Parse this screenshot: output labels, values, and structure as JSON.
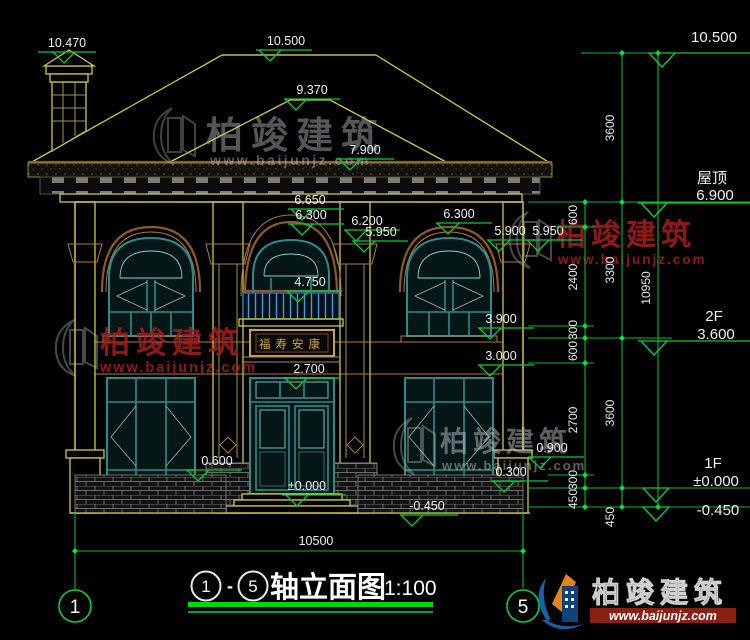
{
  "fm": [
    "10.470",
    "10.500",
    "9.370",
    "7.900",
    "6.650",
    "6.300",
    "6.200",
    "5.950",
    "6.300",
    "5.900",
    "5.950",
    "4.750",
    "3.900",
    "3.000",
    "2.700",
    "0.600",
    "0.900",
    "0.300",
    "±0.000",
    "-0.450"
  ],
  "rp": {
    "top": "10.500",
    "roof_label": "屋顶",
    "roof_elev": "6.900",
    "f2_label": "2F",
    "f2_elev": "3.600",
    "f1_label": "1F",
    "f1_elev": "±0.000",
    "ground_elev": "-0.450"
  },
  "chain": {
    "inner": [
      "600",
      "2400",
      "300",
      "600",
      "2700",
      "300",
      "450"
    ],
    "middle": [
      "3600",
      "3300",
      "3600",
      "450"
    ],
    "outer": [
      "10950"
    ]
  },
  "bottom": {
    "total_width": "10500"
  },
  "axes": {
    "left": "1",
    "right": "5"
  },
  "title": {
    "ax1": "1",
    "sep": "-",
    "ax2": "5",
    "name": "轴立面图",
    "scale": "1:100"
  },
  "plaque": {
    "text": "福寿安康"
  },
  "brand": {
    "name": "柏竣建筑",
    "site": "www.baijunjz.com"
  }
}
